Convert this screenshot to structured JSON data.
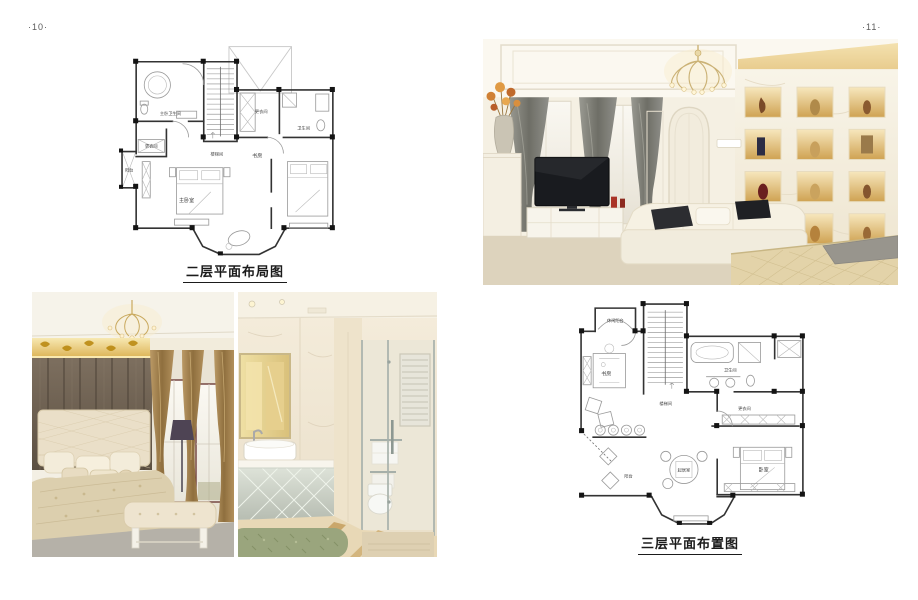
{
  "left_page": {
    "page_number": "·10·",
    "plan": {
      "caption": "二层平面布局图",
      "rooms": {
        "master_bathroom": "主卧卫生间",
        "dressing_left": "更衣间",
        "balcony": "阳台",
        "master_bedroom": "主卧室",
        "stair_hall": "楼梯间",
        "dressing_right": "更衣间",
        "bathroom": "卫生间",
        "study": "书房"
      }
    }
  },
  "right_page": {
    "page_number": "·11·",
    "plan": {
      "caption": "三层平面布置图",
      "rooms": {
        "leisure_balcony": "休闲阳台",
        "study": "书房",
        "bathroom": "卫生间",
        "stair_hall": "楼梯间",
        "dressing": "更衣间",
        "balcony": "阳台",
        "sitting_room": "起居室",
        "bedroom": "卧室"
      }
    }
  },
  "colors": {
    "page_background": "#ffffff",
    "caption_text": "#1b1b1b",
    "page_number_text": "#5a5a5a",
    "plan_wall": "#333333",
    "plan_furniture": "#9a9a9a",
    "gold_accent": "#d9b25c",
    "curtain_gray": "#82827a",
    "curtain_bronze": "#a8854f",
    "rug_green": "#9aa57d"
  }
}
